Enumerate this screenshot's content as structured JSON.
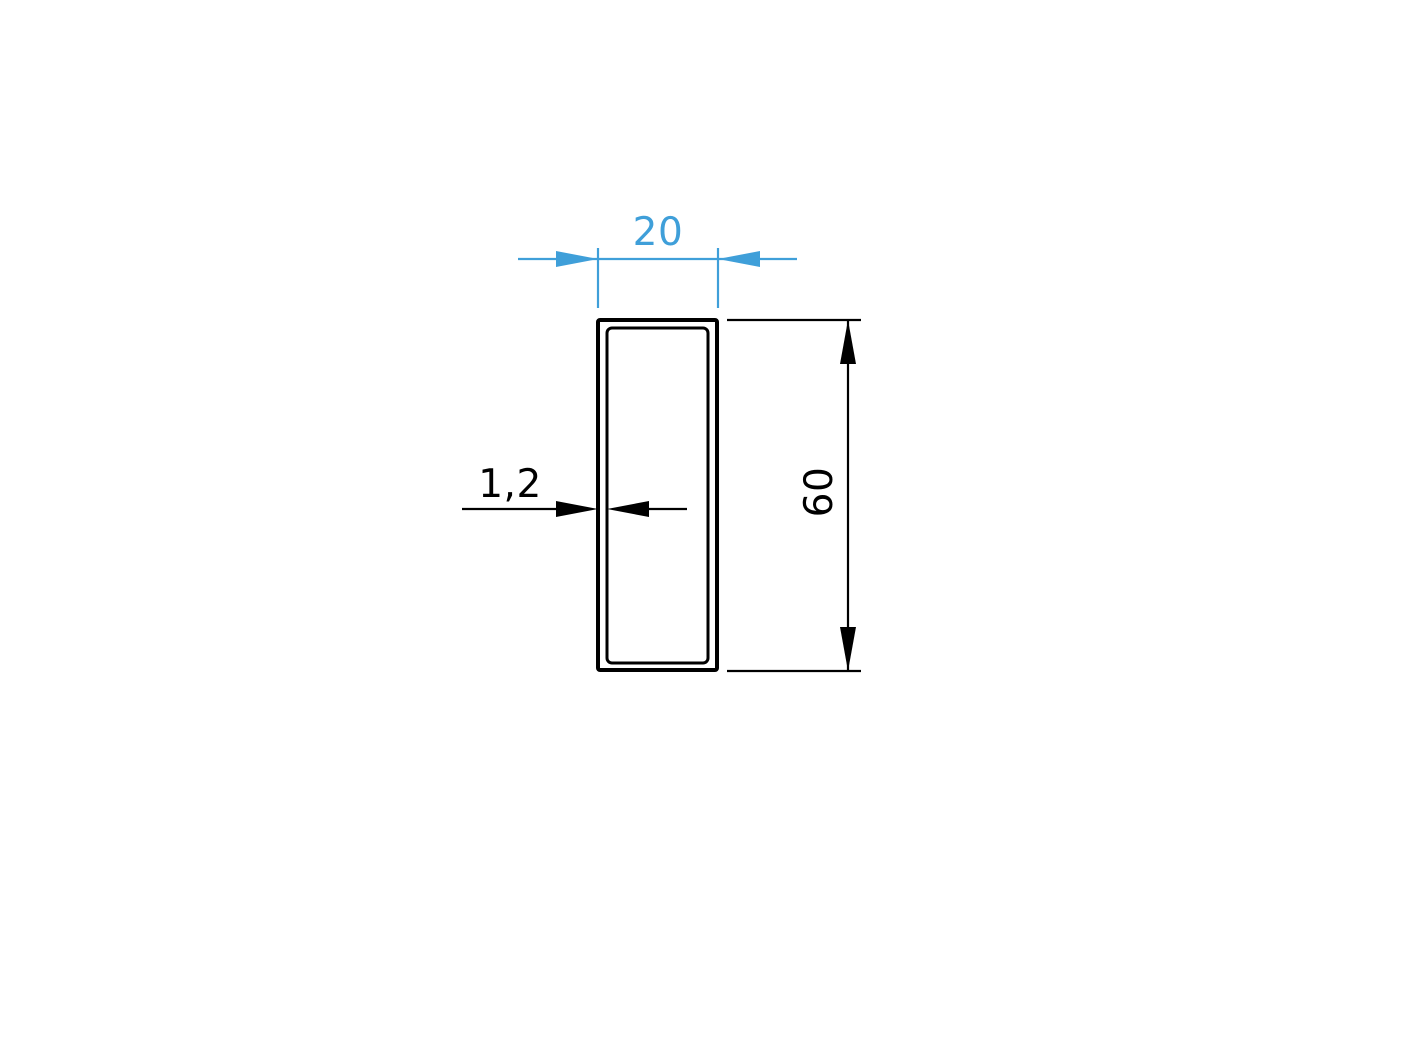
{
  "page": {
    "background": "#ffffff",
    "description": "Technical cross-section drawing of a rectangular hollow tube profile with dimension annotations"
  },
  "colors": {
    "line": "#000000",
    "accent": "#3f9fd9"
  },
  "drawing": {
    "profile_type": "rectangular-hollow-tube",
    "dimensions": {
      "width": "20",
      "height": "60",
      "wall_thickness": "1,2"
    }
  }
}
